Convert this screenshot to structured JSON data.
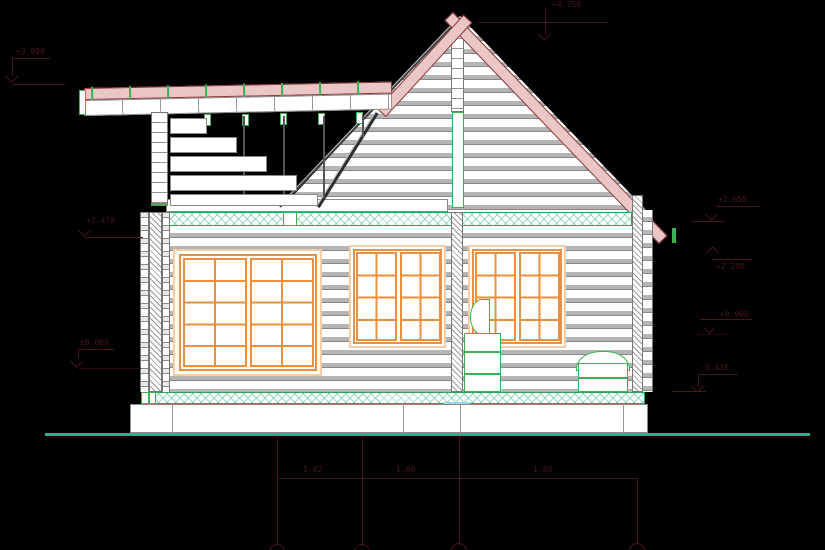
{
  "drawing_type": "house side elevation",
  "levels": {
    "porch_roof": {
      "value": "+3.080"
    },
    "ridge": {
      "value": "+4.750"
    },
    "eave_left": {
      "value": "+2.470"
    },
    "floor": {
      "value": "±0.000"
    },
    "eave_right": {
      "value": "+2.650"
    },
    "window_head": {
      "value": "+2.200"
    },
    "sill": {
      "value": "+0.900"
    },
    "plinth": {
      "value": "-0.430"
    }
  },
  "dimensions": {
    "bays": [
      {
        "value": "1.82"
      },
      {
        "value": "1.00"
      },
      {
        "value": "1.86"
      }
    ]
  },
  "colors": {
    "background": "#000000",
    "accent_green": "#3cb054",
    "roof_pink": "#eac6c6",
    "roof_outline": "#8a3838",
    "window_orange": "#ee8f3c",
    "ground_teal": "#2fae8e",
    "annotation": "#451717"
  }
}
